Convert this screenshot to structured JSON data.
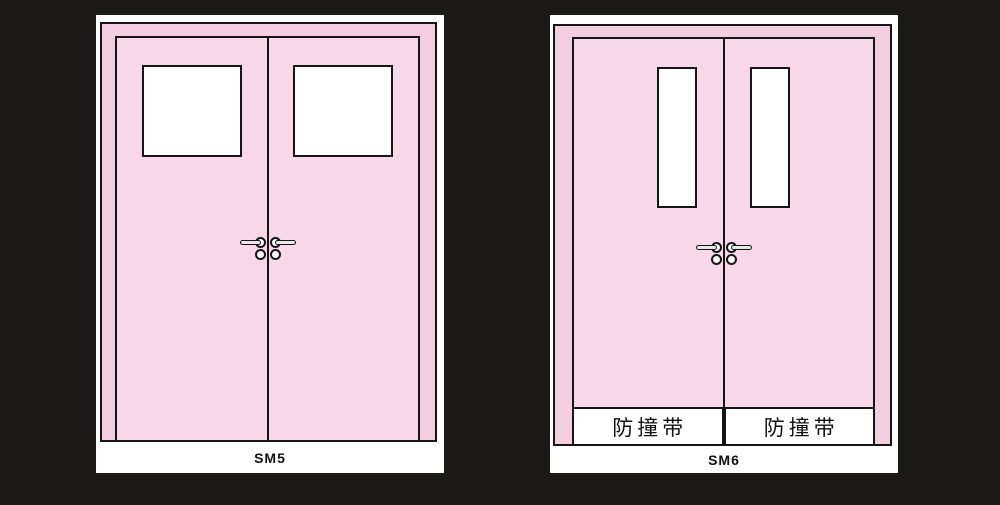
{
  "colors": {
    "background": "#1c1919",
    "panel": "#ffffff",
    "door_frame_pink": "#f3cde0",
    "door_leaf_pink": "#f8d8e8",
    "outline": "#151515"
  },
  "panels": [
    {
      "label": "SM5"
    },
    {
      "label": "SM6",
      "bands": [
        "防撞带",
        "防撞带"
      ]
    }
  ]
}
